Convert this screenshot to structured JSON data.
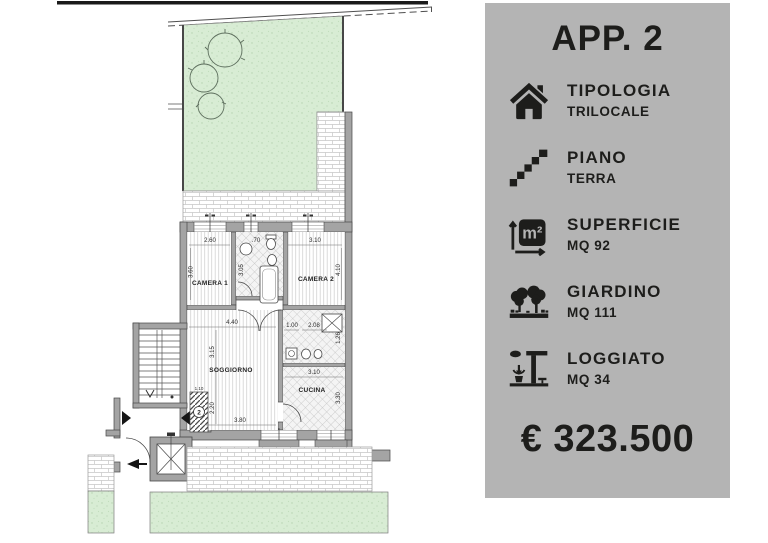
{
  "panel": {
    "title": "APP. 2",
    "price": "€ 323.500",
    "items": [
      {
        "icon": "house-icon",
        "label": "TIPOLOGIA",
        "value": "TRILOCALE"
      },
      {
        "icon": "stairs-icon",
        "label": "PIANO",
        "value": "TERRA"
      },
      {
        "icon": "area-icon",
        "label": "SUPERFICIE",
        "value": "MQ 92",
        "icon_text": "m²"
      },
      {
        "icon": "garden-icon",
        "label": "GIARDINO",
        "value": "MQ 111"
      },
      {
        "icon": "loggia-icon",
        "label": "LOGGIATO",
        "value": "MQ 34"
      }
    ],
    "colors": {
      "panel_bg": "#b4b4b4",
      "text": "#1d1d1b"
    }
  },
  "floorplan": {
    "rooms": {
      "camera1": "CAMERA 1",
      "camera2": "CAMERA 2",
      "soggiorno": "SOGGIORNO",
      "cucina": "CUCINA"
    },
    "unit_number": "2",
    "dims": {
      "camera1_w": "2.60",
      "bath_win": ".70",
      "camera2_w": "3.10",
      "camera1_h": "3.60",
      "bath_h": "3.05",
      "camera2_h": "4.10",
      "soggiorno_w": "4.40",
      "soggiorno_d": "3.15",
      "soggiorno_h": "2.20",
      "soggiorno_w2": "3.80",
      "bath2_w1": "1.00",
      "bath2_w2": "2.08",
      "bath2_h": "1.26",
      "cucina_w": "3.10",
      "cucina_h": "3.30",
      "entry_w": "1.10"
    },
    "colors": {
      "garden": "#d8ecd4",
      "wall": "#a4a4a4",
      "line": "#474747"
    }
  }
}
